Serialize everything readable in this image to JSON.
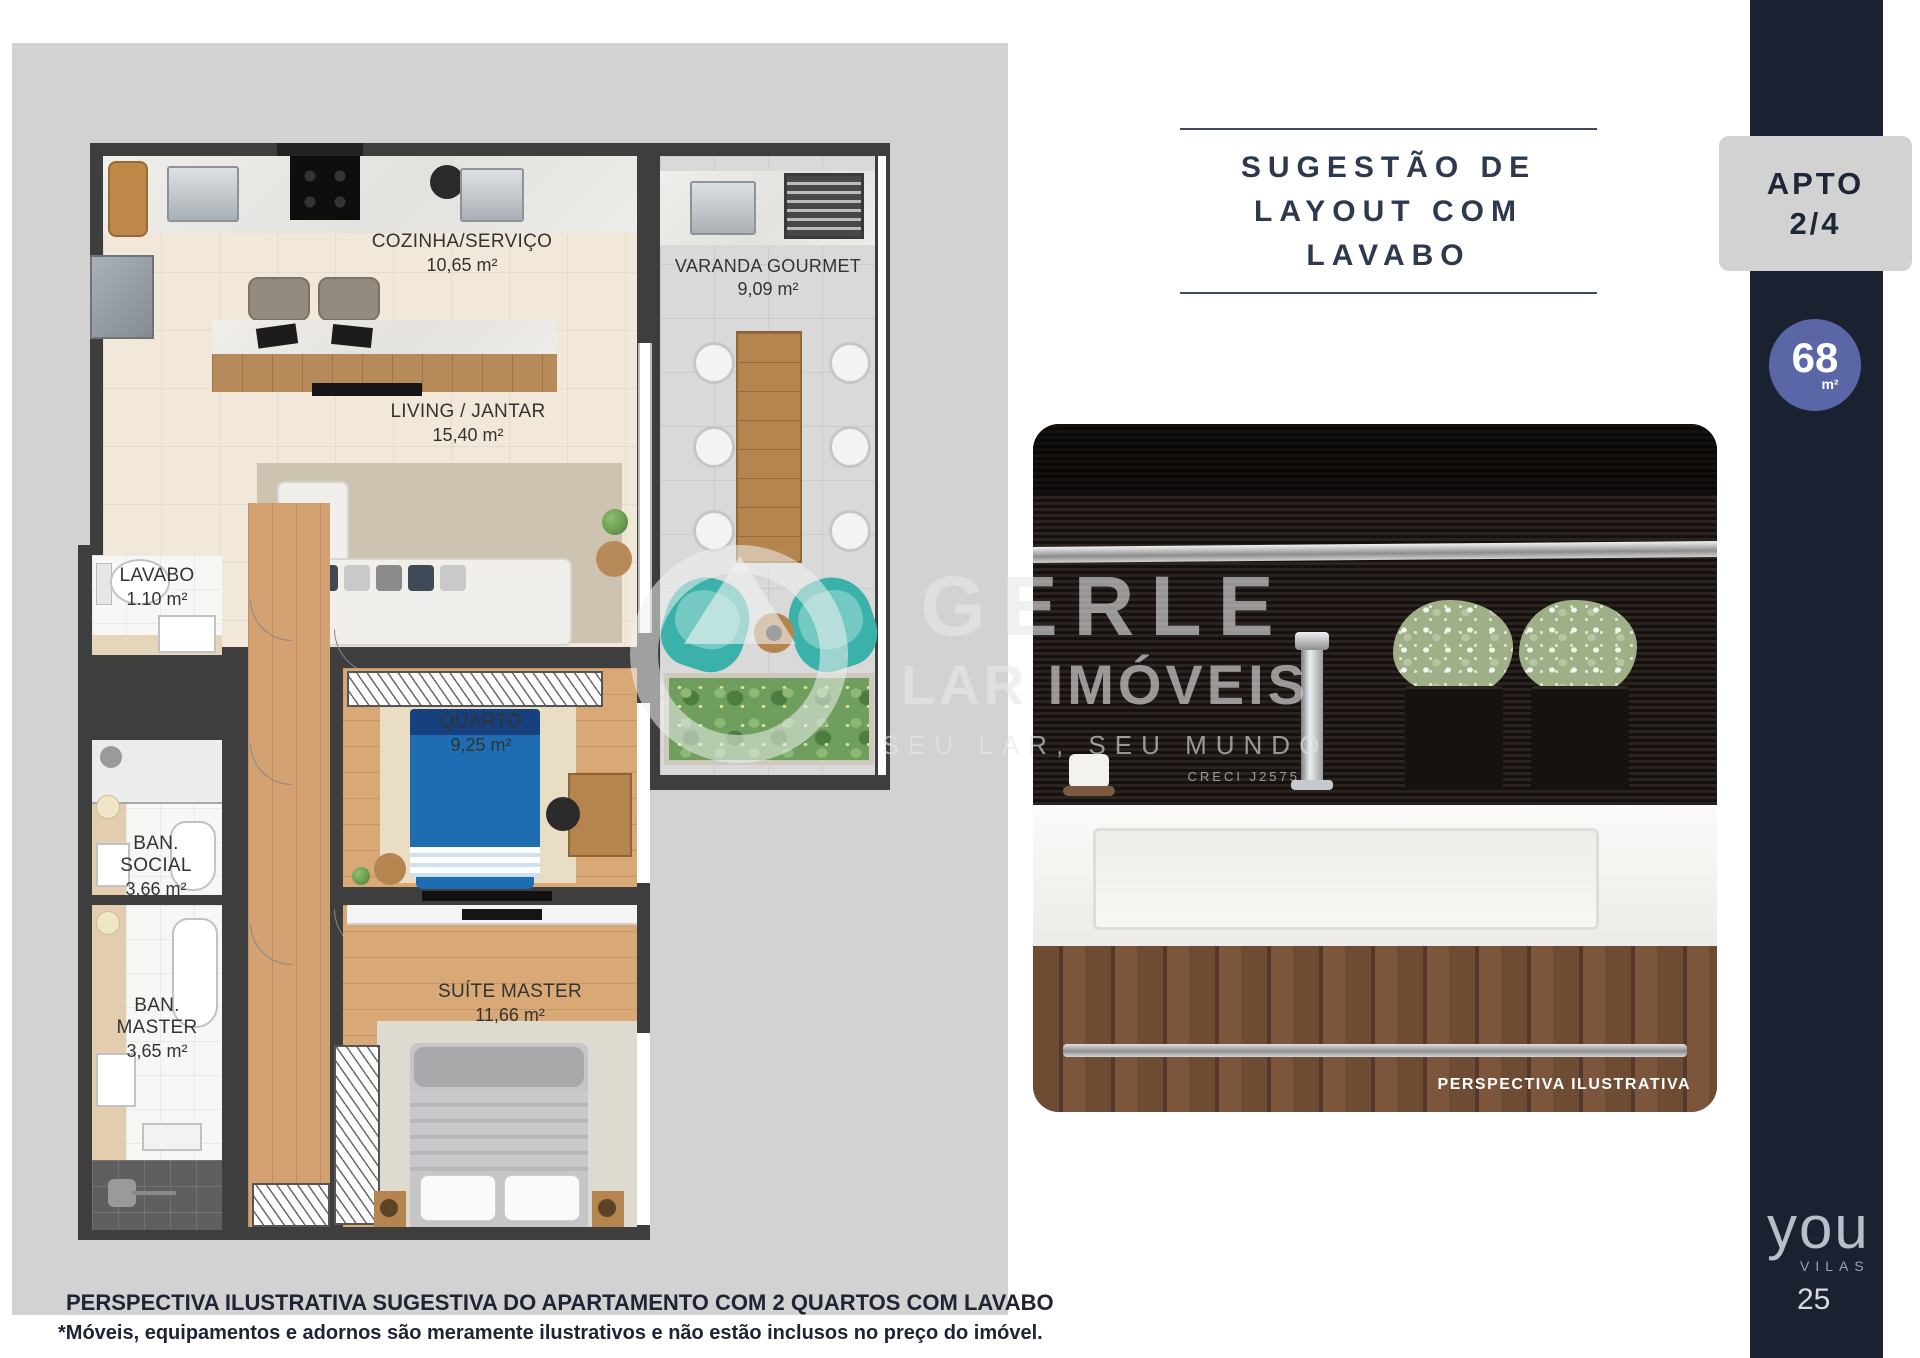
{
  "title": {
    "line1": "SUGESTÃO DE",
    "line2": "LAYOUT COM LAVABO"
  },
  "apto_badge": {
    "line1": "APTO",
    "line2": "2/4"
  },
  "area_badge": {
    "value": "68",
    "unit": "m²"
  },
  "sidebar": {
    "logo_word": "you",
    "logo_sub": "VILAS",
    "page_number": "25",
    "strip_color": "#1a2130",
    "badge_circle_color": "#5b66a7",
    "badge_box_color": "#d2d2d2"
  },
  "floor_plan": {
    "canvas_color": "#d2d2d2",
    "wall_color": "#3e3e3e",
    "accent_teal": "#3bb2a9",
    "bed_blue": "#1e6cb1",
    "rooms": [
      {
        "name": "COZINHA/SERVIÇO",
        "area": "10,65 m²"
      },
      {
        "name": "VARANDA GOURMET",
        "area": "9,09 m²"
      },
      {
        "name": "LIVING / JANTAR",
        "area": "15,40 m²"
      },
      {
        "name": "LAVABO",
        "area": "1.10 m²"
      },
      {
        "name": "QUARTO",
        "area": "9,25 m²"
      },
      {
        "name": "BAN. SOCIAL",
        "area": "3,66 m²"
      },
      {
        "name": "BAN. MASTER",
        "area": "3,65 m²"
      },
      {
        "name": "SUÍTE MASTER",
        "area": "11,66 m²"
      }
    ]
  },
  "photo": {
    "caption": "PERSPECTIVA ILUSTRATIVA"
  },
  "watermark": {
    "word1": "GERLE",
    "word2": "LAR IMÓVEIS",
    "tagline": "SEU LAR, SEU MUNDO",
    "creci": "CRECI J2575"
  },
  "footer": {
    "line1": "PERSPECTIVA ILUSTRATIVA SUGESTIVA DO APARTAMENTO COM 2 QUARTOS  COM LAVABO",
    "line2": "*Móveis, equipamentos e adornos são meramente ilustrativos e não estão inclusos no preço do imóvel."
  }
}
